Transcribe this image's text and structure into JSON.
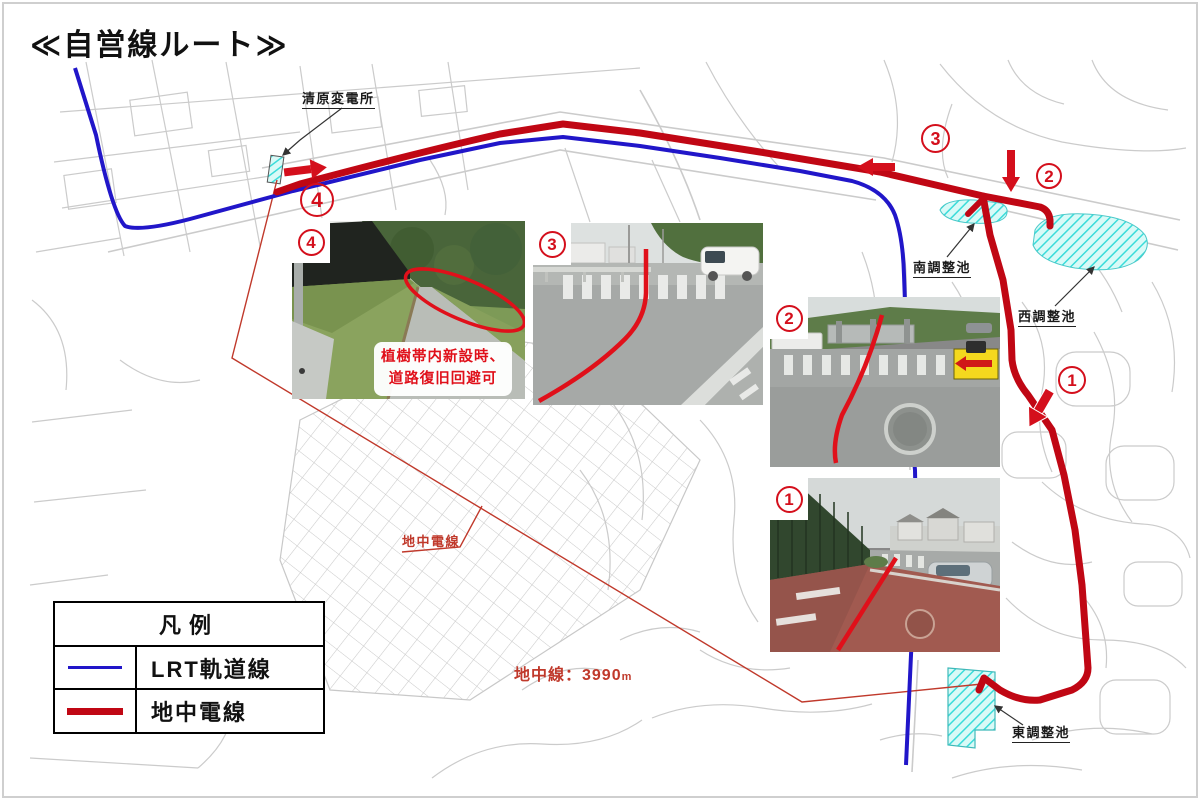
{
  "page": {
    "title": "≪自営線ルート≫"
  },
  "legend": {
    "title": "凡例",
    "items": [
      {
        "label": "LRT軌道線",
        "color": "#2116c9",
        "line_style": "thin"
      },
      {
        "label": "地中電線",
        "color": "#c00714",
        "line_style": "thick"
      }
    ]
  },
  "map": {
    "labels": {
      "substation": "清原変電所",
      "pond_south": "南調整池",
      "pond_west": "西調整池",
      "pond_east": "東調整池",
      "underground_cable": "地中電線",
      "cable_length_value": "地中線：3990",
      "cable_length_unit": "m"
    },
    "markers": [
      {
        "number": "1"
      },
      {
        "number": "2"
      },
      {
        "number": "3"
      },
      {
        "number": "4"
      }
    ],
    "colors": {
      "lrt_line": "#2116c9",
      "underground_cable": "#c00714",
      "annotation_red": "#c0392b",
      "pond_fill": "#c9f6f3",
      "pond_hatch": "#3bdcda",
      "street": "#cbcbcb"
    }
  },
  "photos": [
    {
      "number": "4",
      "caption": [
        "植樹帯内新設時、",
        "道路復旧回避可"
      ]
    },
    {
      "number": "3",
      "caption": []
    },
    {
      "number": "2",
      "caption": []
    },
    {
      "number": "1",
      "caption": []
    }
  ]
}
